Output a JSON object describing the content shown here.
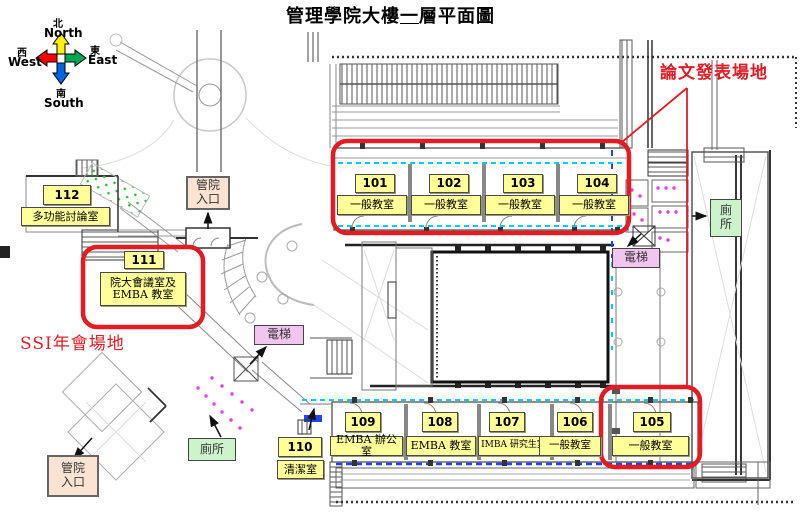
{
  "title": {
    "part1": "管理學院大樓",
    "underlined": "一",
    "part2": "層平面圖"
  },
  "annotations": {
    "paper_venue": "論文發表場地",
    "ssi_venue": "SSI年會場地",
    "highlight_color": "#E31B23"
  },
  "compass": {
    "north_zh": "北",
    "north_en": "North",
    "south_zh": "南",
    "south_en": "South",
    "west_zh": "西",
    "west_en": "West",
    "east_zh": "東",
    "east_en": "East",
    "arrow_colors": {
      "north": "#FFF200",
      "south": "#0066E0",
      "west": "#FF0000",
      "east": "#00A650"
    }
  },
  "rooms": [
    {
      "id": "101",
      "name": "一般教室"
    },
    {
      "id": "102",
      "name": "一般教室"
    },
    {
      "id": "103",
      "name": "一般教室"
    },
    {
      "id": "104",
      "name": "一般教室"
    },
    {
      "id": "105",
      "name": "一般教室"
    },
    {
      "id": "106",
      "name": "一般教室"
    },
    {
      "id": "107",
      "name": "IMBA 研究生室"
    },
    {
      "id": "108",
      "name": "EMBA 教室"
    },
    {
      "id": "109",
      "name": "EMBA 辦公室"
    },
    {
      "id": "110",
      "name": "清潔室"
    },
    {
      "id": "111",
      "name_line1": "院大會議室及",
      "name_line2": "EMBA 教室"
    },
    {
      "id": "112",
      "name": "多功能討論室"
    }
  ],
  "facilities": {
    "entrance_top": {
      "line1": "管院",
      "line2": "入口"
    },
    "entrance_bottom": {
      "line1": "管院",
      "line2": "入口"
    },
    "elevator_center": "電梯",
    "elevator_right": "電梯",
    "toilet_right": {
      "line1": "廁",
      "line2": "所"
    },
    "toilet_left": "廁所"
  },
  "colors": {
    "room_fill": "#FFFF99",
    "entrance_fill": "#FAE3D3",
    "elevator_fill": "#F2C4F0",
    "toilet_fill": "#CDF3CD",
    "window_cyan": "#00CCFF",
    "window_blue": "#2244EE"
  }
}
